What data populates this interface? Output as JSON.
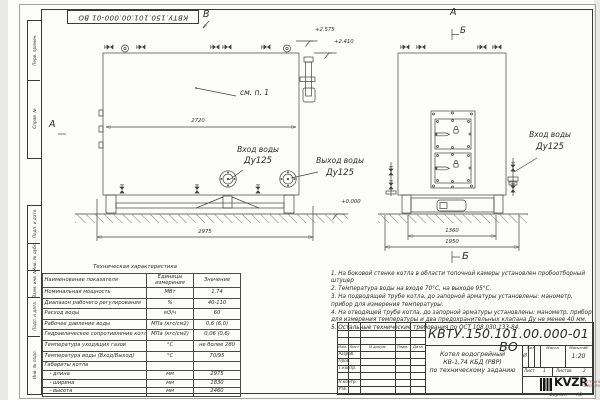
{
  "frame": {
    "doc_number_rotated": "КВТУ.150.101.00.000-01 ВО",
    "left_strip": [
      "Перв. примен.",
      "Справ. №",
      "Подп. и дата",
      "Инв. № дубл.",
      "Взам. инв. №",
      "Подп. и дата",
      "Инв. № подл."
    ],
    "format_label": "Формат",
    "format_value": "А3"
  },
  "views": {
    "side": {
      "label_top": "В",
      "label_left": "А",
      "see_note": "см. п. 1",
      "dim_inner": "2720",
      "dim_base": "2975",
      "elev_1": "+2.575",
      "elev_2": "+2.410",
      "elev_zero": "+0.000",
      "inlet_label": "Вход воды",
      "inlet_dn": "Ду125",
      "outlet_label": "Выход воды",
      "outlet_dn": "Ду125"
    },
    "front": {
      "label_top": "А",
      "section_top": "Б",
      "section_bottom": "Б",
      "dim_inner": "1360",
      "dim_base": "1950",
      "inlet_label": "Вход воды",
      "inlet_dn": "Ду125"
    }
  },
  "tech_table": {
    "title": "Техническая характеристика",
    "headers": [
      "Наименование показателя",
      "Единицы измерения",
      "Значение"
    ],
    "rows": [
      [
        "Номинальная мощность",
        "МВт",
        "1,74"
      ],
      [
        "Диапазон рабочего регулирования",
        "%",
        "40-110"
      ],
      [
        "Расход воды",
        "м3/ч",
        "60"
      ],
      [
        "Рабочее давление воды",
        "МПа (кгс/см2)",
        "0,6 (6,0)"
      ],
      [
        "Гидравлическое сопротивление котла",
        "МПа (кгс/см2)",
        "0,06 (0,6)"
      ],
      [
        "Температура уходящих газов",
        "°С",
        "не более 280"
      ],
      [
        "Температура воды (Вход/Выход)",
        "°С",
        "70/95"
      ],
      [
        "Габариты котла",
        "",
        ""
      ],
      [
        "   - длина",
        "мм",
        "2975"
      ],
      [
        "   - ширина",
        "мм",
        "1830"
      ],
      [
        "   - высота",
        "мм",
        "2460"
      ]
    ]
  },
  "notes": [
    "1.  На боковой стенке котла в области топочной камеры установлен пробоотборный штуцер",
    "2.  Температура воды на входе 70°С, на выходе 95°С.",
    "3.  На подводящей трубе котла, до запорной арматуры установлены: манометр, прибор для измерения температуры.",
    "4.  На отводящей трубе котла, до запорной арматуры установлены: манометр, прибор для измерения температуры и два предохранительных клапана Ду не менее 40 мм.",
    "5.  Остальные технические требования по ОСТ 108.030.133-84."
  ],
  "title_block": {
    "doc_number": "КВТУ.150.101.00.000-01  ВО",
    "product_lines": [
      "Котел водогрейный",
      "КВ-1,74  КБД  (РВР)",
      "по техническому заданию"
    ],
    "rev_headers": [
      "Изм.",
      "Лист",
      "N докум.",
      "Подп.",
      "Дата"
    ],
    "roles": [
      "Разраб.",
      "Пров.",
      "Т.контр.",
      "Н.контр.",
      "Утв."
    ],
    "lit_label": "Лит.",
    "mass_label": "Масса",
    "scale_label": "Масштаб",
    "lit_value": "И",
    "scale_value": "1:20",
    "sheet_label": "Лист",
    "sheet_value": "1",
    "sheets_label": "Листов",
    "sheets_value": "2",
    "logo_text": "KVZR",
    "logo_sub1": "КОТЕЛЬНЫЙ",
    "logo_sub2": "ЗАВОД РЭП"
  }
}
